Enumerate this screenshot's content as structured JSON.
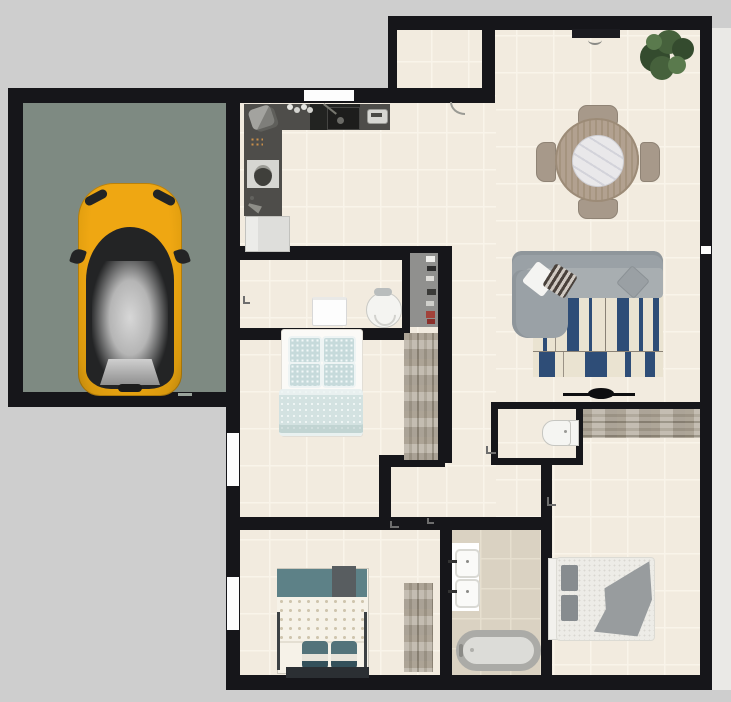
{
  "scene": {
    "label": "2D apartment floor plan with attached garage",
    "width_px": 731,
    "height_px": 702
  },
  "palette": {
    "bg": "#cecece",
    "wall": "#16161a",
    "floor": "#f2ebdf",
    "grout": "#f9f4ea",
    "bath_floor": "#dad2c2",
    "bath_grout": "#e6dfcf",
    "garage_floor": "#7e8a82",
    "exterior": "#eae9e6",
    "window": "#fdfdfd",
    "counter": "#4e4d4a",
    "cooktop": "#222321",
    "fridge": "#dededb",
    "appliance_light": "#d7d7d3",
    "car_yellow": "#efa712",
    "car_dark": "#232425",
    "car_roof": "#d7d7d7",
    "sofa": "#9aa1a6",
    "sofa_dark": "#8f969b",
    "sofa_seat": "#a8aeb1",
    "rug_cream": "#eae3d1",
    "rug_navy": "#2e4d77",
    "pillow_white": "#f4f4f2",
    "pillow_stripe": "#4a423c",
    "pillow_gray": "#9aa0a4",
    "plant_dark": "#344b2e",
    "plant_mid": "#46613c",
    "plant_light": "#5a7a4d",
    "table_wood": "#b2a190",
    "chair_wood": "#a7998a",
    "marble": "#e9e8ea",
    "wood_light": "#bcb4a7",
    "wood_mid": "#a69e90",
    "wood_dark": "#8f8779",
    "shelf": "#90908e",
    "teal_light": "#c6dadb",
    "teal_mid": "#5d8187",
    "teal_dark": "#33505a",
    "linen": "#f6f2e8",
    "duvet_dot": "#cfc5ae",
    "bed3_blanket": "#989c9e",
    "fixture_white": "#f5f5f2",
    "fixture_border": "#c6c6c1",
    "tub_rim": "#ababa7",
    "tub_fill": "#dcdcd8",
    "tv": "#0e0e10",
    "door_leaf": "#1b1b20",
    "mark": "#6e6e6e"
  },
  "rooms": [
    {
      "id": "garage",
      "label": "Garage"
    },
    {
      "id": "kitchen",
      "label": "Kitchen"
    },
    {
      "id": "entry-niche",
      "label": "Entry niche"
    },
    {
      "id": "living-dining",
      "label": "Living / dining room"
    },
    {
      "id": "closet-nook",
      "label": "Closet nook"
    },
    {
      "id": "bedroom-middle",
      "label": "Middle bedroom"
    },
    {
      "id": "hallway",
      "label": "Hallway"
    },
    {
      "id": "wc",
      "label": "WC"
    },
    {
      "id": "bathroom",
      "label": "Bathroom"
    },
    {
      "id": "bedroom-bottom-left",
      "label": "Bottom-left bedroom"
    },
    {
      "id": "bedroom-bottom-right",
      "label": "Bottom-right bedroom"
    }
  ],
  "furniture": [
    {
      "id": "car",
      "label": "Yellow car"
    },
    {
      "id": "kitchen-counter",
      "label": "Kitchen counter"
    },
    {
      "id": "cooktop-sink",
      "label": "Cooktop and sink"
    },
    {
      "id": "toaster",
      "label": "Small appliance"
    },
    {
      "id": "microwave",
      "label": "Microwave"
    },
    {
      "id": "pot-board",
      "label": "Board with pot"
    },
    {
      "id": "fridge",
      "label": "Refrigerator"
    },
    {
      "id": "entry-door",
      "label": "Entry door"
    },
    {
      "id": "dining-table",
      "label": "Round dining table"
    },
    {
      "id": "dining-chair",
      "label": "Dining chair"
    },
    {
      "id": "plant",
      "label": "Potted plant"
    },
    {
      "id": "sofa",
      "label": "Corner sofa"
    },
    {
      "id": "rug",
      "label": "Striped rug"
    },
    {
      "id": "tv",
      "label": "Television"
    },
    {
      "id": "console",
      "label": "Long wardrobe console"
    },
    {
      "id": "shelf",
      "label": "Shelf unit"
    },
    {
      "id": "nook-dresser",
      "label": "White dresser"
    },
    {
      "id": "vanity-chair",
      "label": "Armchair"
    },
    {
      "id": "wardrobe",
      "label": "Wardrobe"
    },
    {
      "id": "bed-middle",
      "label": "Double bed (teal bedding)"
    },
    {
      "id": "bed-bottom-left",
      "label": "Bed (dotted duvet)"
    },
    {
      "id": "dresser-bl",
      "label": "Dresser"
    },
    {
      "id": "toilet",
      "label": "Toilet"
    },
    {
      "id": "bath-vanity",
      "label": "Double sink vanity"
    },
    {
      "id": "bathtub",
      "label": "Bathtub"
    },
    {
      "id": "bed-bottom-right",
      "label": "Double bed (gray blanket)"
    }
  ],
  "openings": {
    "windows": [
      {
        "id": "kitchen-window",
        "label": "Kitchen window (north wall)"
      },
      {
        "id": "bedroom-middle-window",
        "label": "Middle bedroom window (west wall)"
      },
      {
        "id": "bedroom-bl-window",
        "label": "Bottom-left bedroom window (west wall)"
      },
      {
        "id": "east-window",
        "label": "Small east wall window"
      }
    ],
    "doors": [
      {
        "id": "entry-door",
        "label": "Entry door (top wall)"
      },
      {
        "id": "kitchen-niche-door",
        "label": "Niche door with swing arc"
      }
    ]
  }
}
